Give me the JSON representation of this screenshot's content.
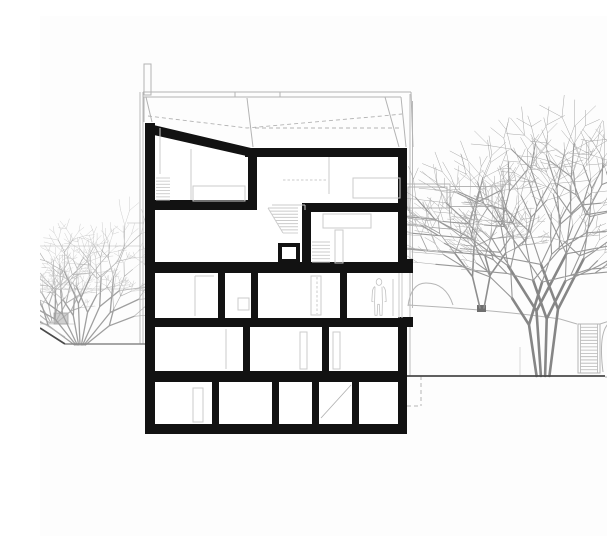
{
  "scene": {
    "canvas": {
      "width": 607,
      "height": 520,
      "background": "#fdfdfd"
    },
    "palette": {
      "section_black": "#121212",
      "detail_gray": "#cbcbcb",
      "faint_gray": "#d9d9d9",
      "outline_gray": "#b3b3b3",
      "ground_dark": "#4a4a4a",
      "ground_mid": "#8a8a8a",
      "ground_light": "#b5b5b5",
      "person_gray": "#c2c2c2"
    },
    "building": {
      "mask_poly": "105,107 211,131 367,131 367,418 105,418",
      "roof_slope_poly": "105,107 211,132 211,141 105,117",
      "black_rects": [
        [
          105,
          107,
          10,
          311
        ],
        [
          205,
          132,
          162,
          9
        ],
        [
          208,
          134,
          9,
          57
        ],
        [
          105,
          184,
          112,
          10
        ],
        [
          262,
          187,
          105,
          9
        ],
        [
          262,
          187,
          9,
          60
        ],
        [
          358,
          132,
          9,
          115
        ],
        [
          105,
          246,
          262,
          11
        ],
        [
          359,
          243,
          14,
          14
        ],
        [
          178,
          257,
          7,
          45
        ],
        [
          211,
          257,
          7,
          45
        ],
        [
          300,
          257,
          7,
          45
        ],
        [
          105,
          302,
          262,
          9
        ],
        [
          358,
          301,
          15,
          10
        ],
        [
          358,
          302,
          9,
          116
        ],
        [
          203,
          311,
          7,
          44
        ],
        [
          282,
          311,
          7,
          44
        ],
        [
          105,
          355,
          262,
          11
        ],
        [
          172,
          366,
          7,
          43
        ],
        [
          232,
          366,
          7,
          43
        ],
        [
          272,
          366,
          7,
          43
        ],
        [
          312,
          366,
          7,
          43
        ],
        [
          105,
          408,
          262,
          10
        ]
      ],
      "stair_box": {
        "outer": [
          238,
          227,
          22,
          20
        ],
        "inner": [
          242,
          231,
          14,
          12
        ]
      },
      "detail_lines": [
        [
          151,
          133,
          151,
          184
        ],
        [
          120,
          112,
          120,
          158
        ],
        [
          289,
          141,
          289,
          178
        ],
        [
          232,
          189,
          265,
          189
        ],
        [
          265,
          189,
          265,
          194
        ],
        [
          186,
          313,
          186,
          353
        ],
        [
          353,
          263,
          353,
          300
        ],
        [
          155,
          260,
          174,
          260
        ],
        [
          155,
          260,
          155,
          300
        ],
        [
          359,
          257,
          359,
          302
        ],
        [
          362,
          257,
          362,
          302
        ]
      ],
      "detail_rects": [
        [
          153,
          170,
          52,
          15
        ],
        [
          313,
          162,
          47,
          20
        ],
        [
          283,
          198,
          48,
          14
        ],
        [
          295,
          214,
          8,
          33
        ],
        [
          198,
          282,
          11,
          12
        ],
        [
          271,
          260,
          10,
          39
        ],
        [
          260,
          316,
          7,
          37
        ],
        [
          293,
          316,
          7,
          37
        ],
        [
          153,
          372,
          10,
          34
        ]
      ],
      "detail_dashed": [
        [
          243,
          164,
          288,
          164
        ],
        [
          277,
          261,
          277,
          298
        ]
      ],
      "diagonals": [
        [
          281,
          402,
          311,
          369
        ]
      ],
      "interior_stairs": [
        {
          "x1": 116,
          "x2": 130,
          "y1": 162,
          "y2": 184,
          "n": 8,
          "slant": 0
        },
        {
          "x1": 228,
          "x2": 258,
          "y1": 192,
          "y2": 217,
          "n": 9,
          "slant": 15
        },
        {
          "x1": 272,
          "x2": 290,
          "y1": 226,
          "y2": 246,
          "n": 7,
          "slant": 0
        }
      ]
    },
    "roof": {
      "lines": [
        [
          103,
          76,
          371,
          76
        ],
        [
          103,
          81,
          361,
          81
        ],
        [
          195,
          76,
          195,
          81
        ],
        [
          240,
          76,
          240,
          81
        ],
        [
          103,
          76,
          103,
          81
        ],
        [
          104,
          81,
          104,
          106
        ],
        [
          106,
          81,
          112,
          106
        ],
        [
          207,
          82,
          213,
          131
        ],
        [
          345,
          81,
          359,
          131
        ],
        [
          361,
          81,
          366,
          131
        ],
        [
          371,
          76,
          373,
          131
        ]
      ],
      "facade_lines": [
        [
          100,
          76,
          100,
          328
        ],
        [
          103,
          81,
          103,
          328
        ],
        [
          370,
          78,
          370,
          360
        ],
        [
          372.5,
          85,
          372.5,
          292
        ]
      ],
      "dashed_polylines": [
        "108,100 207,112 342,100 362,98",
        "215,112 362,112"
      ],
      "chimney": [
        104,
        48,
        7,
        31
      ]
    },
    "site": {
      "bg_faint_lines": [
        [
          0,
          230,
          100,
          230
        ],
        [
          0,
          273,
          103,
          273
        ],
        [
          0,
          308,
          35,
          308
        ],
        [
          87,
          207,
          103,
          207
        ]
      ],
      "ground_dark": [
        [
          367,
          360,
          565,
          360
        ],
        [
          0,
          312,
          25,
          328
        ]
      ],
      "ground_mid": [
        [
          25,
          328,
          105,
          328
        ]
      ],
      "ground_light": [
        [
          565,
          361,
          607,
          362
        ],
        [
          0,
          305,
          25,
          321
        ]
      ],
      "terrain_paths": [
        "M368,290 Q371,267 386,267 Q406,267 413,289",
        "M368,289 C420,292 480,297 520,303 L537,308",
        "M560,308 C575,303 590,299 607,296"
      ],
      "terrain_light_paths": [
        "M480,331 L480,359"
      ],
      "boulder_paths": [
        "M563,356 C560,332 561,314 569,307 C575,302 580,307 581,318 L582,356",
        "M587,356 C585,332 587,312 596,306 C603,302 606,312 606,332 L606,356"
      ],
      "ext_stair": {
        "x": 538,
        "y": 308,
        "w": 22,
        "h": 49,
        "n": 15
      },
      "underground_dashed": [
        [
          381,
          360,
          381,
          390
        ],
        [
          367,
          390,
          381,
          390
        ]
      ],
      "markers": [
        {
          "x": 437,
          "y": 289,
          "w": 9,
          "h": 7,
          "fill": "#6f6f6f",
          "stroke": "none"
        },
        {
          "x": 14,
          "y": 297,
          "w": 14,
          "h": 11,
          "fill": "#cfcfcf",
          "stroke": "#a0a0a0"
        }
      ]
    },
    "balcony": {
      "rects": [
        [
          365,
          168,
          45,
          24
        ],
        [
          368,
          171,
          39,
          21
        ],
        [
          452,
          170,
          10,
          22
        ]
      ],
      "lines": [
        [
          410,
          170.5,
          452,
          170.5
        ],
        [
          410,
          190.5,
          452,
          190.5
        ]
      ]
    },
    "person": {
      "head": {
        "cx": 339,
        "cy": 266,
        "rx": 2.8,
        "ry": 3.4
      },
      "body_path": "M335,270.5 q-2.3,1.2 -2.6,5.5 l-0.6,9.5 1.6,0.2 M343,270.5 q2.3,1.2 2.6,5.5 l0.6,9.5 -1.6,0.2 M335,270.8 l-0.4,15 0.3,13.5 2.2,0 0.6,-11 1.6,0 0.6,11 2.2,0 0.3,-13.5 -0.4,-15"
    },
    "trees": [
      {
        "name": "left-shrub-back",
        "x": 13,
        "y": 307,
        "seed": 5,
        "stems": 6,
        "fan": 50,
        "len": 22,
        "ratio": 0.68,
        "depth": 4,
        "splay": 24,
        "baseSpread": 1.1,
        "colors": [
          "#b2b2b2",
          "#bebebe",
          "#c9c9c9"
        ],
        "widths": [
          1.1,
          0.6,
          0.35
        ]
      },
      {
        "name": "left-shrub",
        "x": 40,
        "y": 329,
        "seed": 11,
        "stems": 9,
        "fan": 52,
        "len": 36,
        "ratio": 0.7,
        "depth": 5,
        "splay": 24,
        "baseSpread": 1.2,
        "colors": [
          "#9f9f9f",
          "#b0b0b0",
          "#bfbfbf"
        ],
        "widths": [
          1.3,
          0.65,
          0.38
        ]
      },
      {
        "name": "right-tree-small",
        "x": 442,
        "y": 292,
        "seed": 23,
        "stems": 2,
        "fan": 12,
        "len": 34,
        "ratio": 0.78,
        "depth": 5,
        "splay": 27,
        "baseSpread": 2.0,
        "colors": [
          "#8e8e8e",
          "#9e9e9e",
          "#aeaeae"
        ],
        "widths": [
          1.6,
          0.8,
          0.45
        ]
      },
      {
        "name": "right-tree-large",
        "x": 503,
        "y": 360,
        "seed": 42,
        "stems": 4,
        "fan": 7,
        "len": 62,
        "ratio": 0.79,
        "depth": 6,
        "splay": 26,
        "baseSpread": 3.2,
        "colors": [
          "#868686",
          "#979797",
          "#a8a8a8"
        ],
        "widths": [
          2.6,
          1.1,
          0.5
        ]
      }
    ]
  }
}
